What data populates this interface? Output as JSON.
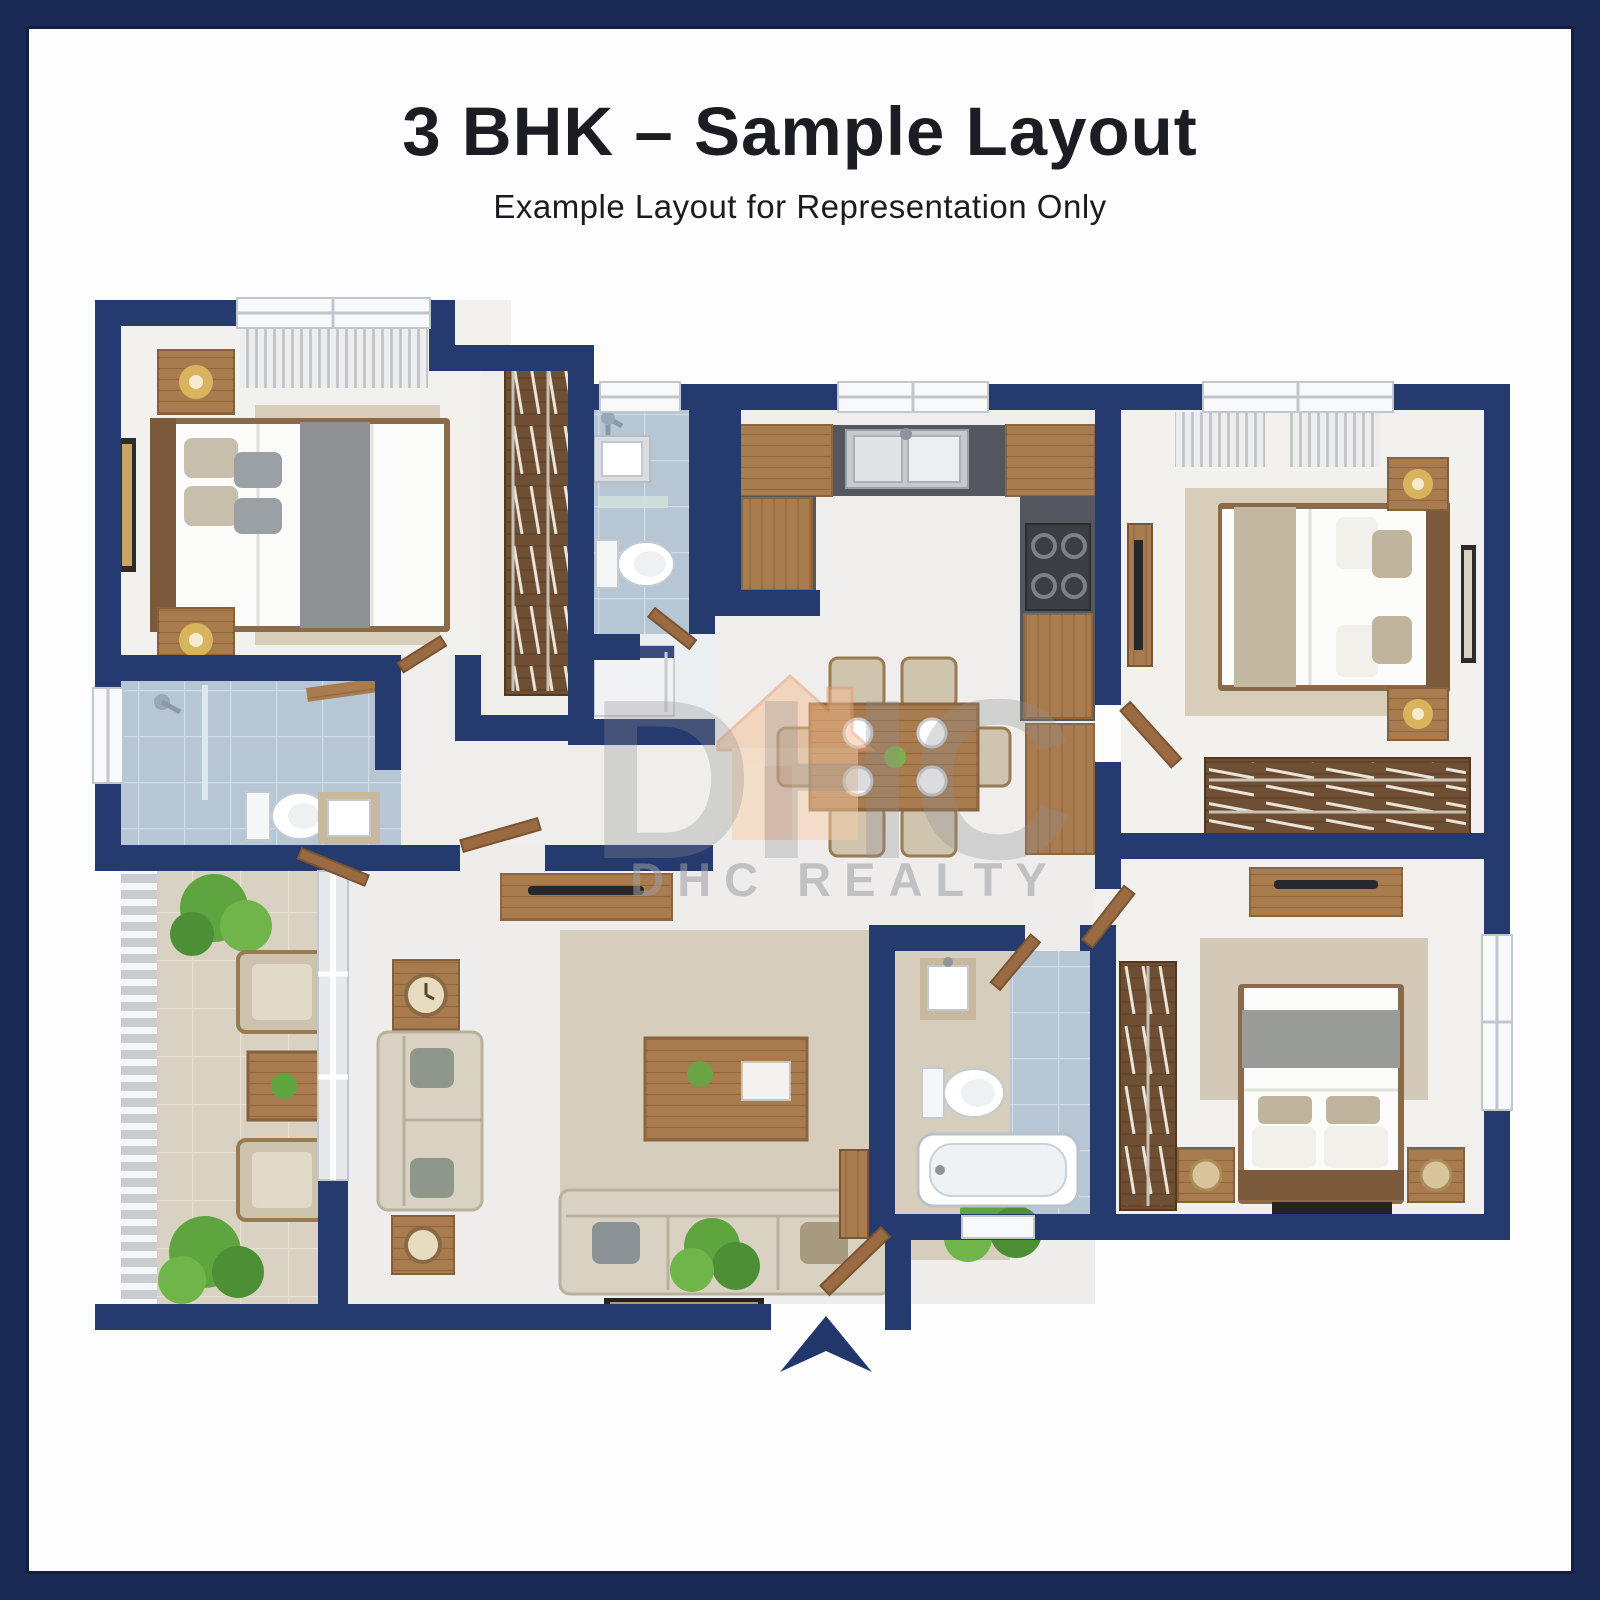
{
  "header": {
    "title": "3 BHK – Sample Layout",
    "subtitle": "Example Layout for Representation Only"
  },
  "watermark": {
    "logo_text": "DHC",
    "brand_text": "DHC REALTY"
  },
  "floorplan": {
    "entrance_marker": "entrance-arrow",
    "colors": {
      "wall_navy": "#253a6f",
      "frame_navy": "#1b2a55",
      "bathroom_tile": "#b7c6d5",
      "balcony_tile": "#d9d2c2",
      "wood": "#a97c4f",
      "wood_dark": "#6f4f33",
      "counter_dark": "#54575d",
      "rug_beige": "#d8cdb9",
      "sofa_beige": "#d9d2c3",
      "plant_green": "#5ea53f",
      "watermark_peach": "#f5bd92"
    }
  }
}
